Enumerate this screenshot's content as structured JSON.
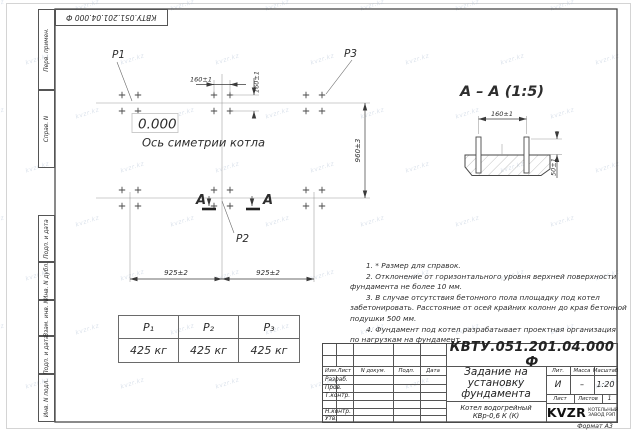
{
  "watermark": {
    "text": "kvzr.kz"
  },
  "colors": {
    "line": "#3a3a3a",
    "thin_line": "#999999",
    "text": "#2d2d2d",
    "watermark": "#b8c6d8",
    "paper": "#ffffff"
  },
  "top_stamp": {
    "doc_number": "КВТУ.051.201.04.000  Ф"
  },
  "margin_labels": {
    "perv_primen": "Перв. примен.",
    "sprav_n": "Справ. N",
    "podp_data_1": "Подп. и дата",
    "inv_n_dubl": "Инв. N дубл.",
    "vzam_inv_n": "Взам. инв. N",
    "podp_data_2": "Подп. и дата",
    "inv_n_podl": "Инв. N подл."
  },
  "plan": {
    "label_p1": "P1",
    "label_p2": "P2",
    "label_p3": "P3",
    "elevation": "0.000",
    "axis_caption": "Ось симетрии котла",
    "dim_160_horizontal": "160±1",
    "dim_160_vertical": "160±1",
    "dim_960": "960±3",
    "dim_925_left": "925±2",
    "dim_925_right": "925±2",
    "section_mark_left": "А",
    "section_mark_right": "А"
  },
  "section": {
    "title": "А – А (1:5)",
    "dim_160": "160±1",
    "dim_50": "50±1"
  },
  "loads_table": {
    "headers": [
      "P₁",
      "P₂",
      "P₃"
    ],
    "values": [
      "425 кг",
      "425 кг",
      "425 кг"
    ]
  },
  "notes_lines": [
    "1. * Размер для справок.",
    "2. Отклонение от горизонтального уровня верхней поверхности",
    "фундамента не более 10 мм.",
    "3. В случае отсутствия бетонного пола площадку под котел",
    "забетонировать. Расстояние от осей крайних колонн до края бетонной",
    "подушки 500 мм.",
    "4. Фундамент под котел разрабатывает проектная организация",
    "по нагрузкам на фундамент."
  ],
  "title_block": {
    "doc_number": "КВТУ.051.201.04.000  Ф",
    "rev_headers": {
      "izm": "Изм.Лист",
      "doc": "N докум.",
      "podp": "Подп.",
      "data": "Дата"
    },
    "rows": {
      "razrab": "Разраб.",
      "prov": "Пров.",
      "tkontr": "Т.контр.",
      "nkontr": "Н.контр.",
      "utv": "Утв."
    },
    "title": "Задание на установку фундамента",
    "product": "Котел водогрейный КВр-0,6 К (К)",
    "lit_label": "Лит.",
    "lit_value": "И",
    "mass_label": "Масса",
    "mass_value": "–",
    "scale_label": "Масштаб",
    "scale_value": "1:20",
    "sheet_label": "Лист",
    "sheets_label": "Листов",
    "sheets_value": "1",
    "company": "KVZR",
    "company_line1": "КОТЕЛЬНЫЙ",
    "company_line2": "ЗАВОД РЭП",
    "format": "Формат А3"
  }
}
